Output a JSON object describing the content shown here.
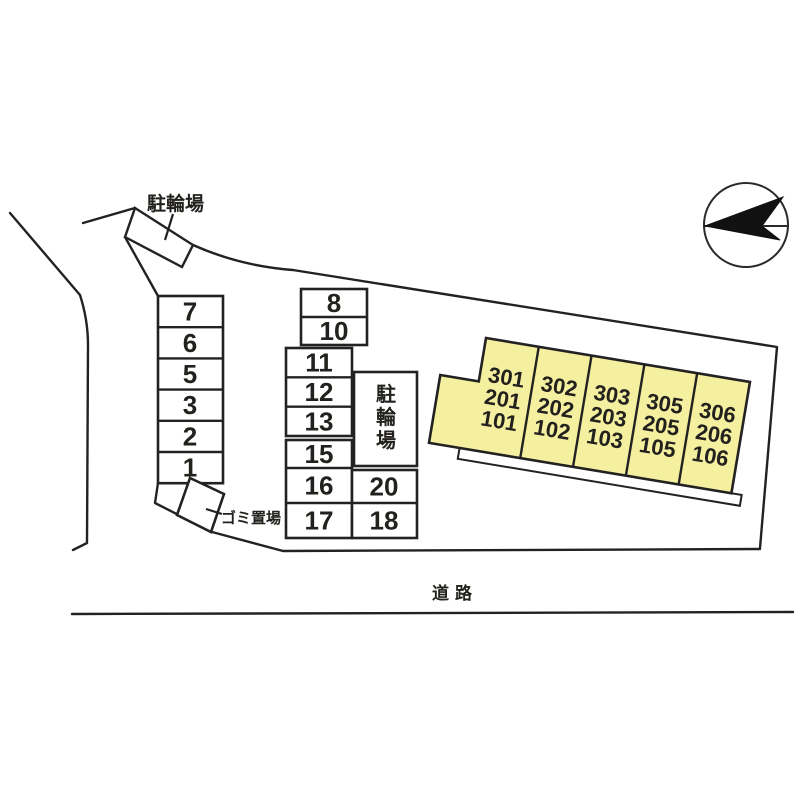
{
  "figure": {
    "type": "apartment-site-plan",
    "colors": {
      "background": "#ffffff",
      "line": "#222222",
      "building_fill": "#f5efa0",
      "needle_fill": "#111111"
    },
    "labels": {
      "bicycle_parking_top": "駐輪場",
      "bicycle_parking_mid": [
        "駐",
        "輪",
        "場"
      ],
      "garbage_area": "ゴミ置場",
      "road": "道路"
    },
    "parking_spaces": {
      "left_column": [
        "7",
        "6",
        "5",
        "3",
        "2",
        "1"
      ],
      "upper_middle": [
        "8",
        "10"
      ],
      "middle": [
        "11",
        "12",
        "13"
      ],
      "lower_middle": [
        "15",
        "16",
        "17"
      ],
      "middle_right": [
        "20",
        "18"
      ]
    },
    "building_units": [
      {
        "lines": [
          "301",
          "201",
          "101"
        ]
      },
      {
        "lines": [
          "302",
          "202",
          "102"
        ]
      },
      {
        "lines": [
          "303",
          "203",
          "103"
        ]
      },
      {
        "lines": [
          "305",
          "205",
          "105"
        ]
      },
      {
        "lines": [
          "306",
          "206",
          "106"
        ]
      }
    ],
    "compass": {
      "icon": "north-arrow"
    }
  }
}
